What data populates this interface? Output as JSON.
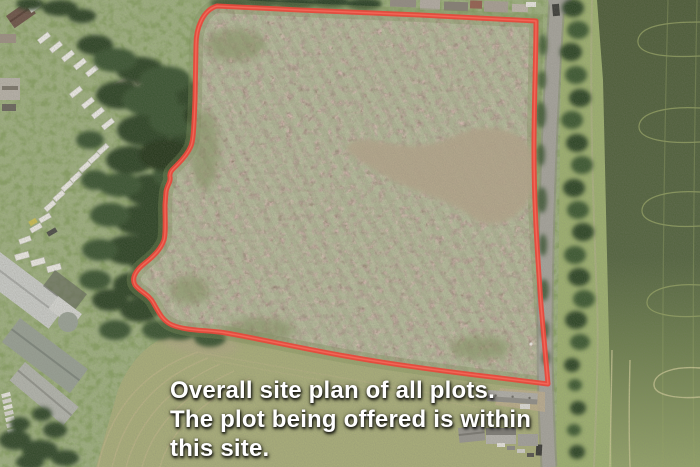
{
  "scene": {
    "type": "aerial-site-plan-photo",
    "caption": {
      "lines": [
        "Overall site plan of all plots.",
        "The plot being offered is within",
        "this site."
      ],
      "text_color": "#ffffff"
    },
    "boundary": {
      "label": "site-boundary",
      "color": "#e8473a"
    },
    "palette": {
      "scrub_field": "#95826f",
      "bare_earth_patch": "#b5a78c",
      "grass": "#89a164",
      "woodland": "#33492c",
      "crop_field_top": "#4e5d39",
      "crop_field_bottom": "#93a369",
      "meadow": "#a9ae7a",
      "road": "#a6a49c",
      "roof_grey": "#b3b1ab",
      "caravan_white": "#eeede7"
    }
  }
}
